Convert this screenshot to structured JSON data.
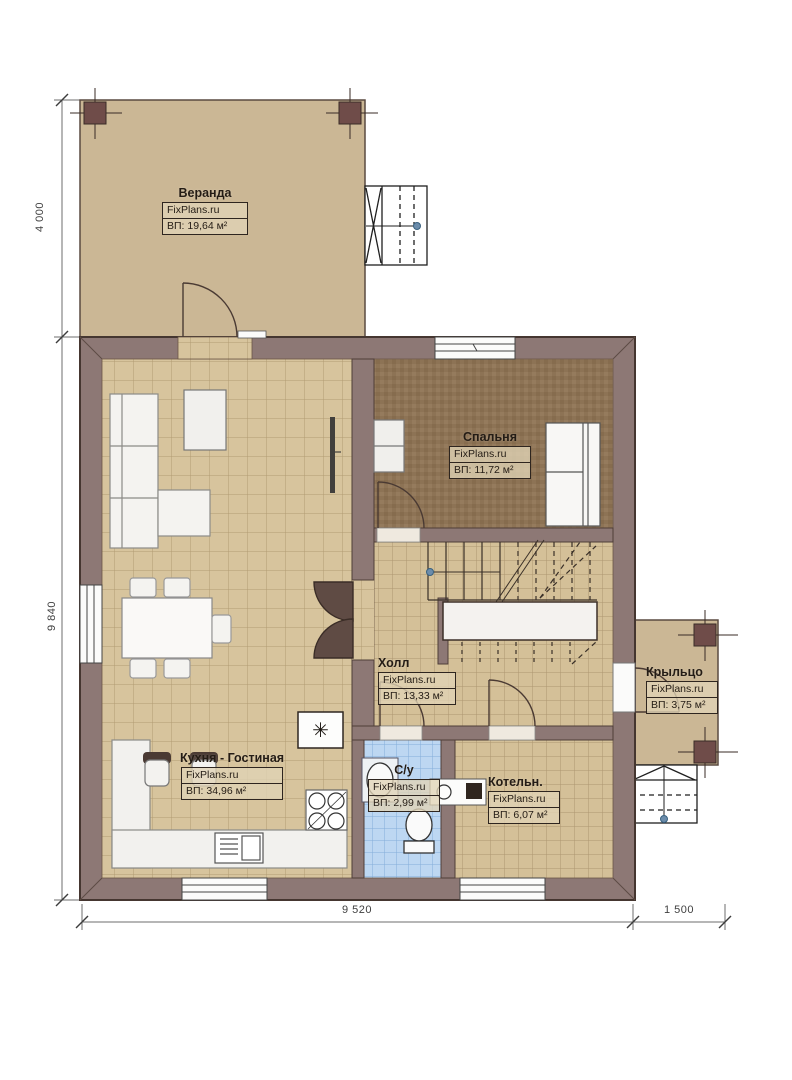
{
  "plan": {
    "rooms": [
      {
        "name": "Веранда",
        "brand": "FixPlans.ru",
        "area": "ВП: 19,64 м²"
      },
      {
        "name": "Спальня",
        "brand": "FixPlans.ru",
        "area": "ВП: 11,72 м²"
      },
      {
        "name": "Холл",
        "brand": "FixPlans.ru",
        "area": "ВП: 13,33 м²"
      },
      {
        "name": "Кухня - Гостиная",
        "brand": "FixPlans.ru",
        "area": "ВП: 34,96 м²"
      },
      {
        "name": "С/у",
        "brand": "FixPlans.ru",
        "area": "ВП: 2,99 м²"
      },
      {
        "name": "Котельн.",
        "brand": "FixPlans.ru",
        "area": "ВП: 6,07 м²"
      },
      {
        "name": "Крыльцо",
        "brand": "FixPlans.ru",
        "area": "ВП: 3,75 м²"
      }
    ],
    "dimensions": {
      "veranda_depth": "4 000",
      "house_depth": "9 840",
      "house_width": "9 520",
      "porch_width": "1 500"
    },
    "icons": {
      "fridge_snowflake": "✳"
    },
    "colors": {
      "wall": "#8d7875",
      "tile_floor": "#d7c49d",
      "bedroom_floor": "#8d7355",
      "bath_tile": "#bdd7f2",
      "deck": "#cbb795",
      "corner_post": "#6f4c49"
    }
  }
}
